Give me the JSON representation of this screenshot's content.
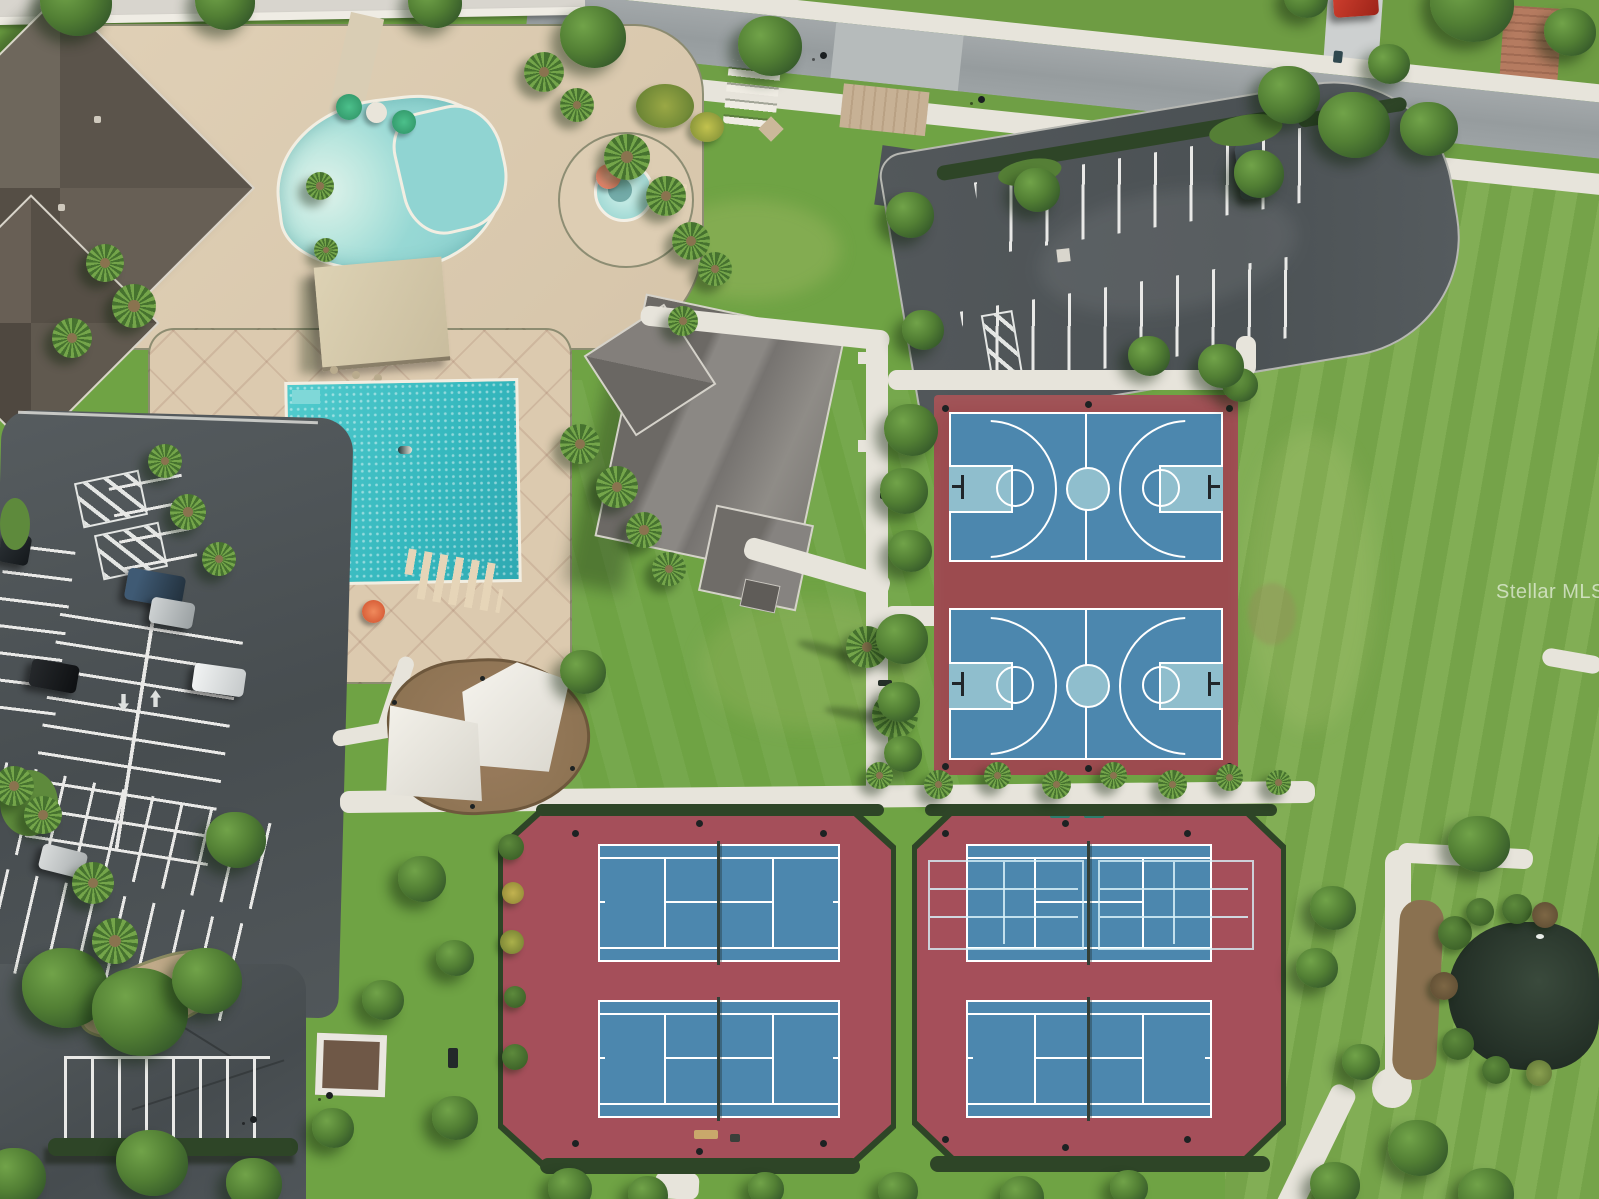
{
  "watermark": {
    "text": "Stellar MLS"
  },
  "colors": {
    "grass": "#6fa344",
    "grassDark": "#4e7c33",
    "lawnRight": "#7aa94c",
    "deck": "#dbcab0",
    "poolWater": "#9ad8d4",
    "lapWater": "#3fc4c8",
    "courtBlue": "#4c87ae",
    "courtBlueLight": "#8fbecd",
    "bballRed": "#9c4b4f",
    "tennisRed": "#a54f5a",
    "fenceGreen": "#2e4527",
    "asphalt": "#4e5457",
    "road": "#9aa0a2",
    "sidewalk": "#e7e4db",
    "roofGray": "#878480",
    "roofBrown": "#5e574e",
    "sailWhite": "#f3f1ea",
    "mulch": "#8a7150",
    "pond": "#2c3a2e",
    "stallLine": "#e9e9e7",
    "paver": "#c7b195",
    "umbrellaGreen": "#3aa877",
    "umbrellaOrange": "#e2663f",
    "umbrellaCoral": "#ee8a70",
    "carRed": "#c23226",
    "watermarkColor": "#ffffff"
  }
}
